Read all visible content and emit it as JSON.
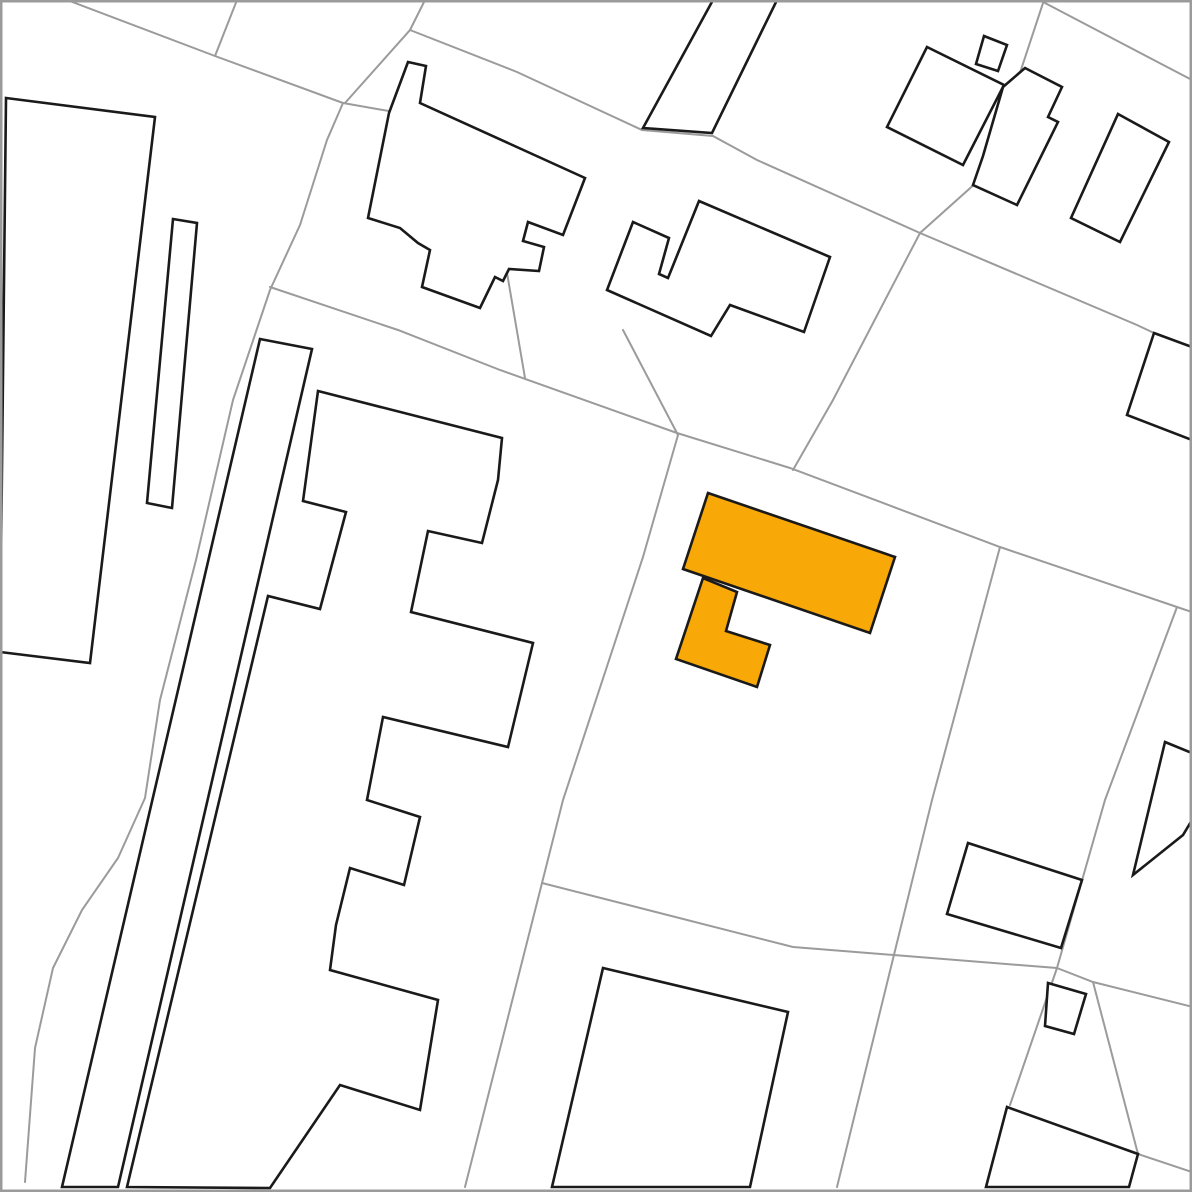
{
  "map": {
    "width": 1192,
    "height": 1192,
    "background": "#ffffff",
    "colors": {
      "parcel_line": "#9b9b9b",
      "building_fill": "#ffffff",
      "building_stroke": "#1a1a1a",
      "highlight_fill": "#f8a807",
      "highlight_stroke": "#1a1a1a",
      "border": "#9b9b9b"
    },
    "stroke_widths": {
      "parcel": 2,
      "building": 2.6,
      "border": 2.5
    },
    "parcel_lines": [
      {
        "id": "road-curve-west",
        "points": [
          [
            67,
            0
          ],
          [
            215,
            56
          ],
          [
            343,
            103
          ],
          [
            327,
            140
          ],
          [
            300,
            225
          ],
          [
            270,
            290
          ],
          [
            233,
            400
          ],
          [
            196,
            560
          ],
          [
            160,
            700
          ],
          [
            145,
            798
          ],
          [
            118,
            858
          ],
          [
            82,
            910
          ],
          [
            53,
            968
          ],
          [
            35,
            1048
          ],
          [
            25,
            1182
          ]
        ]
      },
      {
        "id": "boundary-top-joiner",
        "points": [
          [
            237,
            0
          ],
          [
            215,
            56
          ]
        ]
      },
      {
        "id": "boundary-shallow-topleft",
        "points": [
          [
            343,
            103
          ],
          [
            400,
            113
          ],
          [
            479,
            137
          ]
        ]
      },
      {
        "id": "boundary-steep-top",
        "points": [
          [
            425,
            0
          ],
          [
            410,
            30
          ],
          [
            345,
            103
          ]
        ]
      },
      {
        "id": "diagonal-upper",
        "points": [
          [
            410,
            30
          ],
          [
            517,
            72
          ],
          [
            642,
            130
          ],
          [
            713,
            136
          ],
          [
            757,
            160
          ],
          [
            920,
            233
          ],
          [
            1137,
            325
          ],
          [
            1154,
            333
          ]
        ]
      },
      {
        "id": "boundary-topright-steep",
        "points": [
          [
            1044,
            0
          ],
          [
            987,
            173
          ],
          [
            920,
            233
          ],
          [
            833,
            400
          ],
          [
            793,
            470
          ]
        ]
      },
      {
        "id": "boundary-topright-east",
        "points": [
          [
            1045,
            3
          ],
          [
            1192,
            80
          ]
        ]
      },
      {
        "id": "diagonal-lower",
        "points": [
          [
            270,
            287
          ],
          [
            398,
            330
          ],
          [
            500,
            370
          ],
          [
            677,
            433
          ],
          [
            790,
            468
          ],
          [
            1000,
            547
          ],
          [
            1177,
            607
          ],
          [
            1192,
            612
          ]
        ]
      },
      {
        "id": "boundary-center-vertical-upper",
        "points": [
          [
            479,
            137
          ],
          [
            506,
            267
          ],
          [
            525,
            378
          ]
        ]
      },
      {
        "id": "boundary-center-vertical-lower",
        "points": [
          [
            678,
            435
          ],
          [
            643,
            557
          ],
          [
            563,
            800
          ],
          [
            542,
            883
          ],
          [
            465,
            1187
          ]
        ]
      },
      {
        "id": "boundary-midparcel-branch",
        "points": [
          [
            623,
            330
          ],
          [
            678,
            435
          ]
        ]
      },
      {
        "id": "boundary-east-vertical",
        "points": [
          [
            1000,
            547
          ],
          [
            932,
            800
          ],
          [
            837,
            1187
          ]
        ]
      },
      {
        "id": "boundary-bottom-horizontal",
        "points": [
          [
            542,
            883
          ],
          [
            793,
            947
          ],
          [
            1057,
            968
          ]
        ]
      },
      {
        "id": "boundary-southeast-steep",
        "points": [
          [
            1177,
            607
          ],
          [
            1105,
            800
          ],
          [
            1057,
            968
          ]
        ]
      },
      {
        "id": "path-corridor-left",
        "points": [
          [
            1057,
            968
          ],
          [
            1010,
            1105
          ]
        ]
      },
      {
        "id": "path-corridor-upper",
        "points": [
          [
            1057,
            968
          ],
          [
            1093,
            982
          ],
          [
            1193,
            1007
          ]
        ]
      },
      {
        "id": "path-corridor-right",
        "points": [
          [
            1093,
            982
          ],
          [
            1138,
            1154
          ]
        ]
      },
      {
        "id": "path-corridor-lowest",
        "points": [
          [
            1138,
            1154
          ],
          [
            1192,
            1172
          ]
        ]
      }
    ],
    "buildings": [
      {
        "id": "building-west-large",
        "points": [
          [
            6,
            98
          ],
          [
            155,
            117
          ],
          [
            90,
            663
          ],
          [
            0,
            652
          ]
        ]
      },
      {
        "id": "building-west-narrow-strip",
        "points": [
          [
            173,
            219
          ],
          [
            197,
            223
          ],
          [
            172,
            508
          ],
          [
            147,
            503
          ]
        ]
      },
      {
        "id": "building-long-strip",
        "points": [
          [
            260,
            339
          ],
          [
            312,
            349
          ],
          [
            118,
            1187
          ],
          [
            62,
            1187
          ]
        ]
      },
      {
        "id": "building-apartment-comb",
        "points": [
          [
            318,
            391
          ],
          [
            502,
            438
          ],
          [
            498,
            480
          ],
          [
            482,
            543
          ],
          [
            428,
            531
          ],
          [
            411,
            612
          ],
          [
            533,
            643
          ],
          [
            508,
            747
          ],
          [
            383,
            717
          ],
          [
            367,
            800
          ],
          [
            420,
            817
          ],
          [
            404,
            885
          ],
          [
            350,
            868
          ],
          [
            336,
            925
          ],
          [
            330,
            970
          ],
          [
            438,
            1000
          ],
          [
            420,
            1110
          ],
          [
            340,
            1085
          ],
          [
            270,
            1188
          ],
          [
            127,
            1187
          ],
          [
            268,
            596
          ],
          [
            320,
            609
          ],
          [
            346,
            512
          ],
          [
            303,
            501
          ]
        ]
      },
      {
        "id": "building-topcenter-cluster",
        "points": [
          [
            408,
            62
          ],
          [
            426,
            66
          ],
          [
            420,
            103
          ],
          [
            585,
            178
          ],
          [
            563,
            235
          ],
          [
            528,
            222
          ],
          [
            523,
            241
          ],
          [
            544,
            247
          ],
          [
            539,
            271
          ],
          [
            509,
            269
          ],
          [
            503,
            281
          ],
          [
            495,
            277
          ],
          [
            480,
            308
          ],
          [
            422,
            287
          ],
          [
            430,
            250
          ],
          [
            418,
            243
          ],
          [
            400,
            228
          ],
          [
            368,
            218
          ],
          [
            389,
            113
          ]
        ]
      },
      {
        "id": "building-top-parallelogram",
        "points": [
          [
            713,
            0
          ],
          [
            777,
            0
          ],
          [
            712,
            133
          ],
          [
            643,
            128
          ]
        ]
      },
      {
        "id": "building-mid-hook",
        "points": [
          [
            699,
            201
          ],
          [
            830,
            257
          ],
          [
            804,
            332
          ],
          [
            730,
            305
          ],
          [
            711,
            336
          ],
          [
            607,
            290
          ],
          [
            633,
            222
          ],
          [
            669,
            238
          ],
          [
            659,
            274
          ],
          [
            668,
            278
          ]
        ]
      },
      {
        "id": "building-topright-small-square",
        "points": [
          [
            984,
            36
          ],
          [
            1007,
            45
          ],
          [
            998,
            71
          ],
          [
            976,
            64
          ]
        ]
      },
      {
        "id": "building-topright-rotated-square",
        "points": [
          [
            927,
            47
          ],
          [
            1004,
            85
          ],
          [
            963,
            165
          ],
          [
            887,
            127
          ]
        ]
      },
      {
        "id": "building-topright-stepped",
        "points": [
          [
            1025,
            68
          ],
          [
            1062,
            87
          ],
          [
            1048,
            117
          ],
          [
            1058,
            122
          ],
          [
            1017,
            205
          ],
          [
            973,
            185
          ],
          [
            983,
            156
          ],
          [
            1003,
            87
          ]
        ]
      },
      {
        "id": "building-topright-rect",
        "points": [
          [
            1118,
            114
          ],
          [
            1169,
            142
          ],
          [
            1120,
            242
          ],
          [
            1071,
            218
          ]
        ]
      },
      {
        "id": "building-east-edge-upper",
        "points": [
          [
            1154,
            333
          ],
          [
            1192,
            347
          ],
          [
            1192,
            440
          ],
          [
            1127,
            415
          ]
        ]
      },
      {
        "id": "building-east-edge-mid",
        "points": [
          [
            1165,
            742
          ],
          [
            1192,
            753
          ],
          [
            1192,
            820
          ],
          [
            1183,
            835
          ],
          [
            1133,
            875
          ]
        ]
      },
      {
        "id": "building-southeast-rect",
        "points": [
          [
            968,
            843
          ],
          [
            1082,
            880
          ],
          [
            1061,
            948
          ],
          [
            947,
            914
          ]
        ]
      },
      {
        "id": "building-southeast-small-square",
        "points": [
          [
            1048,
            983
          ],
          [
            1086,
            994
          ],
          [
            1074,
            1034
          ],
          [
            1045,
            1026
          ]
        ]
      },
      {
        "id": "building-southeast-bottom",
        "points": [
          [
            1007,
            1107
          ],
          [
            1138,
            1154
          ],
          [
            1129,
            1187
          ],
          [
            986,
            1187
          ]
        ]
      },
      {
        "id": "building-south-trapezoid",
        "points": [
          [
            603,
            968
          ],
          [
            788,
            1012
          ],
          [
            750,
            1187
          ],
          [
            552,
            1187
          ]
        ]
      }
    ],
    "highlighted_buildings": [
      {
        "id": "highlighted-building-wing",
        "points": [
          [
            703,
            578
          ],
          [
            676,
            659
          ],
          [
            757,
            687
          ],
          [
            770,
            645
          ],
          [
            726,
            631
          ],
          [
            737,
            592
          ]
        ]
      },
      {
        "id": "highlighted-building-main",
        "points": [
          [
            708,
            493
          ],
          [
            895,
            557
          ],
          [
            870,
            633
          ],
          [
            683,
            569
          ]
        ]
      }
    ]
  }
}
